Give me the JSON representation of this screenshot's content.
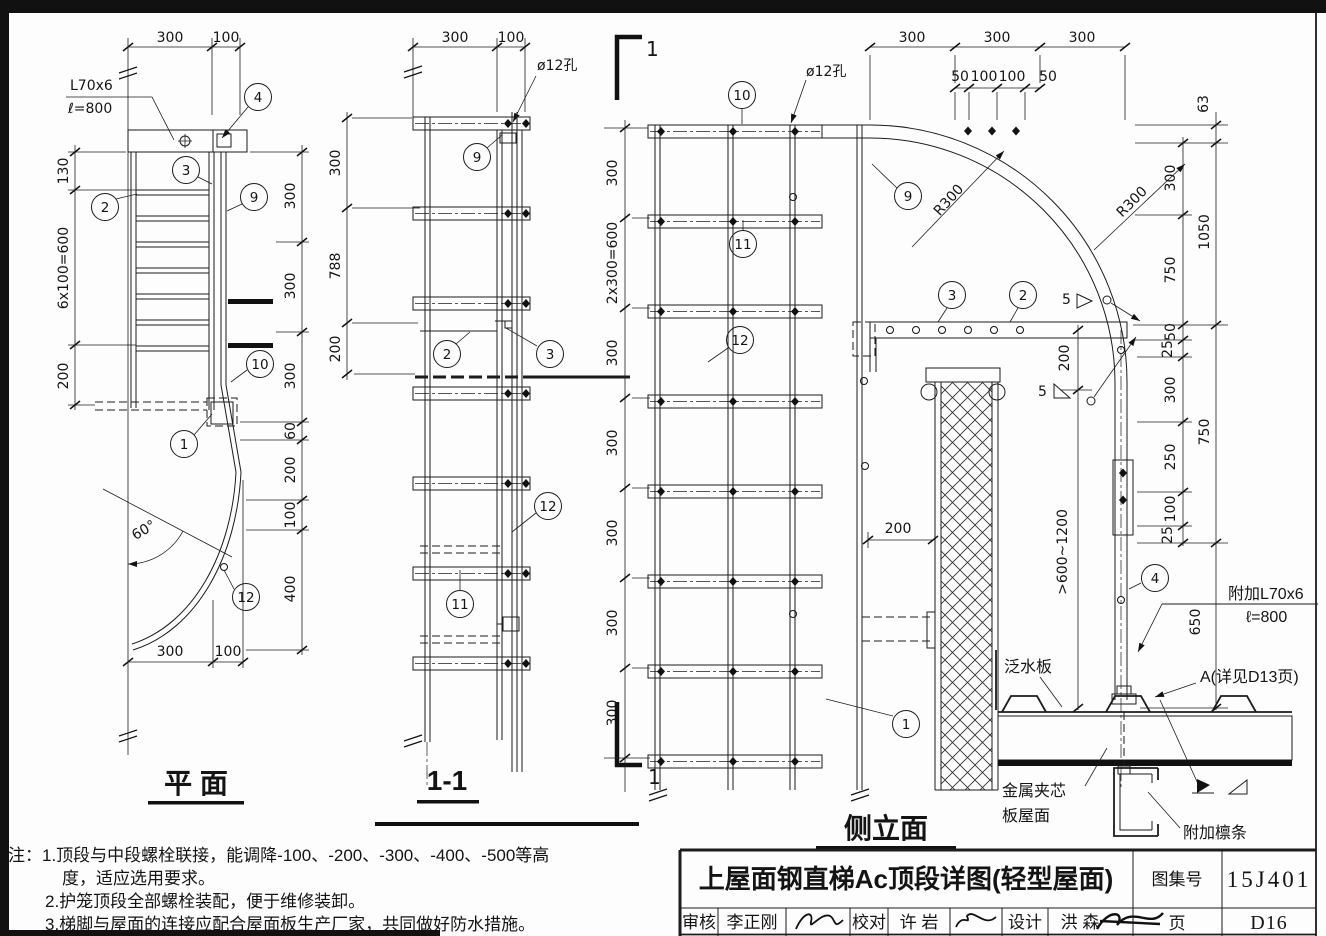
{
  "plan": {
    "title": "平 面",
    "angle_spec": "L70x6",
    "angle_len": "ℓ=800",
    "angle_deg": "60°",
    "dim_top": [
      "300",
      "100"
    ],
    "dim_bottom": [
      "300",
      "100"
    ],
    "dim_left": [
      "130",
      "6x100=600",
      "200"
    ],
    "dim_right": [
      "300",
      "300",
      "300",
      "60",
      "200",
      "100",
      "400"
    ],
    "callouts": {
      "c1": "1",
      "c2": "2",
      "c3": "3",
      "c4": "4",
      "c9": "9",
      "c10": "10",
      "c12": "12"
    }
  },
  "section": {
    "title": "1-1",
    "hole": "ø12孔",
    "dim_top": [
      "300",
      "100"
    ],
    "dim_left": [
      "300",
      "788",
      "200"
    ],
    "callouts": {
      "c2": "2",
      "c3": "3",
      "c9": "9",
      "c11": "11",
      "c12": "12"
    }
  },
  "elev": {
    "title": "侧立面",
    "cut_label": "1",
    "hole": "ø12孔",
    "r300": "R300",
    "weld_size": "5",
    "dim_top": [
      "300",
      "300",
      "300"
    ],
    "dim_top_sub": [
      "50",
      "100",
      "100",
      "50"
    ],
    "dim_left": [
      "300",
      "2x300=600",
      "300",
      "300",
      "300",
      "300",
      "300"
    ],
    "dim_right_outer": [
      "63",
      "1050",
      "750",
      "650"
    ],
    "dim_right_inner": [
      "300",
      "750",
      "50",
      "25",
      "300",
      "250",
      "100",
      "25"
    ],
    "dim_200v": "200",
    "dim_200h": "200",
    "dim_range": ">600~1200",
    "add_angle": "附加L70x6",
    "add_angle_len": "ℓ=800",
    "flashing": "泛水板",
    "detail_a": "A(详见D13页)",
    "roof_line1": "金属夹芯",
    "roof_line2": "板屋面",
    "purlin": "附加檩条",
    "callouts": {
      "c1": "1",
      "c2": "2",
      "c3": "3",
      "c4": "4",
      "c9": "9",
      "c10": "10",
      "c11": "11",
      "c12": "12"
    }
  },
  "notes": {
    "l1": "注：1.顶段与中段螺栓联接，能调降-100、-200、-300、-400、-500等高",
    "l2": "度，适应选用要求。",
    "l3": "2.护笼顶段全部螺栓装配，便于维修装卸。",
    "l4": "3.梯脚与屋面的连接应配合屋面板生产厂家，共同做好防水措施。"
  },
  "titleblock": {
    "title": "上屋面钢直梯Ac顶段详图(轻型屋面)",
    "atlas_label": "图集号",
    "atlas_no": "15J401",
    "page_label": "页",
    "page_no": "D16",
    "audit_label": "审核",
    "audit_name": "李正刚",
    "proof_label": "校对",
    "proof_name": "许 岩",
    "design_label": "设计",
    "design_name": "洪 森"
  }
}
